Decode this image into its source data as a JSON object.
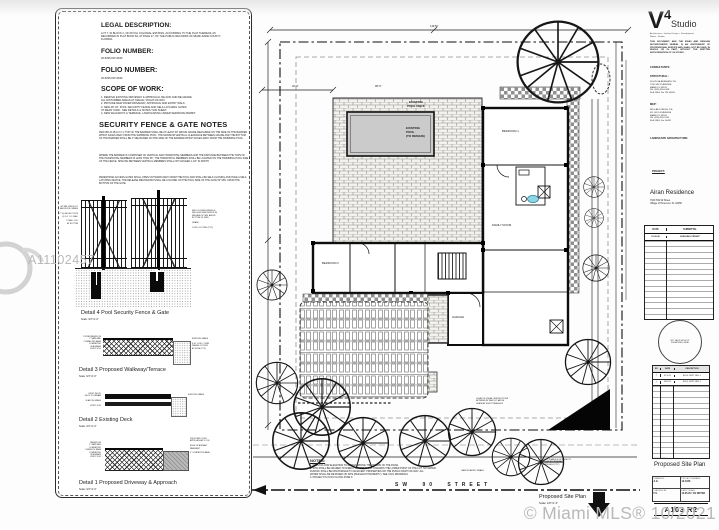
{
  "watermarks": {
    "listing_number": "A11102457",
    "mls_credit": "© Miami MLS® 10/2021"
  },
  "panel": {
    "legal_title": "LEGAL DESCRIPTION:",
    "legal_body": "LOT 7, IN BLOCK 2, OF ROYAL COLONIAL ESTATES, ACCORDING TO THE PLAT THEREOF, AS RECORDED IN PLAT BOOK 84, AT PAGE 27, OF THE PUBLIC RECORDS OF MIAMI-DADE COUNTY, FLORIDA.",
    "folio1_title": "FOLIO NUMBER:",
    "folio1_value": "20-5035-007-0630",
    "folio2_title": "FOLIO NUMBER:",
    "folio2_value": "20-5035-007-0630",
    "scope_title": "SCOPE OF WORK:",
    "scope_items": "1.  REMOVE EXISTING DRIVEWAY & APPROACH. RE-SOD AND RE-GRADE\n     ALL DISTURBED AREAS AT SWALE / RIGHT-OF-WAY.\n2.  PROVIDE NEW PAVER DRIVEWAY, APPROACH AND ENTRY WALK.\n3.  NEW 48\" HT. POOL SECURITY FENCE AND SELF-LATCHING GATES\n     AT REAR YARD - SEE DETAILS & NOTES THIS SHEET.\n4.  NEW WALKWAYS & TERRACE. LANDSCAPING UNDER SEPARATE PERMIT.",
    "security_title": "SECURITY FENCE & GATE NOTES",
    "security_p1": "PER FBC-R 454.2.17.1: TOP OF THE BARRIER SHALL BE AT LEAST 48\" ABOVE GRADE MEASURED ON THE SIDE OF THE BARRIER WHICH FACES AWAY FROM THE SWIMMING POOL. THE MAXIMUM VERTICAL CLEARANCE BETWEEN GRADE AND THE BOTTOM OF THE BARRIER SHALL BE 2\" MEASURED ON THE SIDE OF THE BARRIER WHICH FACES AWAY FROM THE SWIMMING POOL.",
    "security_p2": "WHERE THE BARRIER IS COMPOSED OF VERTICAL AND HORIZONTAL MEMBERS AND THE DISTANCE BETWEEN THE TOPS OF THE HORIZONTAL MEMBERS IS LESS THAN 45\", THE HORIZONTAL MEMBERS SHALL BE LOCATED ON THE SWIMMING POOL SIDE OF THE FENCE. SPACING BETWEEN VERTICAL MEMBERS SHALL NOT EXCEED 1-3/4\" IN WIDTH.",
    "security_p3": "PEDESTRIAN ACCESS GATES SHALL OPEN OUTWARD AWAY FROM THE POOL AND SHALL BE SELF-CLOSING AND HAVE A SELF-LATCHING DEVICE. THE RELEASE MECHANISM SHALL BE LOCATED ON THE POOL SIDE OF THE GATE 54\" MIN. FROM THE BOTTOM OF THE GATE.",
    "d4_label": "Detail 4 Pool Security Fence & Gate",
    "d4_scale": "Scale: 3/4\"=1'-0\"",
    "d4_ann_left": "48\" MIN. FENCE HT.\nABOVE FIN. GRADE\n\n2\" SQ. ALUM. POSTS\n@ 6'-0\" O.C. MAX.\n\n2\" MAX. CLR.\nAT BOTTOM",
    "d4_ann_right": "SELF-CLOSING HINGES &\nSELF-LATCHING DEVICE W/\nRELEASE 54\" MIN. ABOVE\nBOTTOM OF GATE\n\nGRADE\n\nCONC. FOOTING (TYP.)",
    "d3_label": "Detail 3 Proposed Walkway/Terrace",
    "d3_scale": "Scale: 3/4\"=1'-0\"",
    "d3_ann_left": "STONE PAVERS ON\n1\" SAND BED\nCOMPACTED BASE\nCOMPACTED\nSUBGRADE\nEXIST. SOIL",
    "d3_ann_right": "EXISTING GRADE\n\n6\"x6\" CONC. CURB\nWHERE OCCURS\nAT EDGE (TYP.)",
    "d2_label": "Detail 2 Existing Deck",
    "d2_scale": "Scale: 3/4\"=1'-0\"",
    "d2_ann_left": "EXIST. WOOD\nDECK TO REMAIN\n\nSLAB ON GRADE\n\nEXIST. SOIL",
    "d2_ann_right": "EXISTING GRADE",
    "d1_label": "Detail 1 Proposed Driveway & Approach",
    "d1_scale": "Scale: 3/4\"=1'-0\"",
    "d1_ann_left": "PAVERS ON\n1\" SAND BED\nCOMPACTED\nLIMEROCK BASE\nCOMPACTED\nSUBGRADE\nEXIST. SOIL",
    "d1_ann_right": "PROPOSED CONC.\nAPPROACH AT R.O.W.\n\nEDGE OF ASPHALT\nPAVEMENT\n\n6\" COMPACTED BASE"
  },
  "plan": {
    "dim_top": "149.50'",
    "dim_a": "40'-0\"",
    "dim_b": "98'-0\"",
    "pool_deck_label": "EXISTING\nPOOL DECK",
    "pool_label": "EXISTING\nPOOL\n(TO REMAIN)",
    "room1": "BEDROOM 1",
    "room2": "BEDROOM 2",
    "room3": "FAMILY ROOM",
    "room4": "GARAGE",
    "street": "SW 90 STREET",
    "notes_title": "NOTES:",
    "notes_body": "1.  FINISH FLOOR ELEVATION TO REMAIN ABOVE THE CROWN OF THE ROAD.\n2.  SITE SHALL BE GRADED TO DIRECT STREET FLOW TOWARDS THE LOWER POINT OF THE LOT. NO WATER\n     RUNOFF SHALL BE DISCHARGED TO ADJACENT PROPERTIES OR THE PUBLIC RIGHT-OF-WAY. ALL\n     WATER SHALL BE RETAINED ON SITE (PER EACH PROPERTY). SEE CIVIL DRAWINGS.\n3.  PROJECT IS IN NO FLOOD ZONE X.",
    "sight_note": "CLEAR OF VISUAL OBSTRUCTIONS\nBETWEEN 30\" AND 8'-0\" ABOVE\nGRADE AT SIGHT TRIANGLES",
    "sight_note2": "KEEP TRIANGLE OF VISIBILITY\nCLEAR AT DRIVEWAY\nAPPROACH (TYP.)",
    "swale": "LANDSCAPED SWALE",
    "title": "Proposed Site Plan",
    "scale": "Scale: 1/8\"=1'-0\""
  },
  "titleblock": {
    "logo_v": "V",
    "logo_4": "4",
    "logo_studio": "Studio",
    "tagline": "Architecture + Interior Design + Development\nMiami  ·  Florida",
    "copyright": "THIS DOCUMENT, AND THE IDEAS AND DESIGNS INCORPORATED HEREIN, IS AN INSTRUMENT OF PROFESSIONAL SERVICE AND SHALL NOT BE USED, IN WHOLE OR IN PART, WITHOUT THE WRITTEN AUTHORIZATION OF V4 STUDIO.",
    "consultants_label": "CONSULTANTS:",
    "structural_label": "STRUCTURAL:",
    "structural": "FULVIO ALBERGHINI, P.E.\n7700 SW 57 AVENUE\nMIAMI, FL 33143\nPH. (305) 555-0148\nFLA. REG. No. PE 55456",
    "mep_label": "MEP:",
    "mep": "BID-LAB STRUSS, P.E.\n411 SW 142 AVENUE\nMIAMI, FL 33184\nPH. (305) 555-2145\nFLA. REG. No. 60421",
    "landscape_label": "LANDSCAPE ARCHITECTURE:",
    "project_label": "PROJECT:",
    "project_name": "Airan Residence",
    "project_address": "7020 SW 90 Street\nVillage of Pinecrest, FL 33156",
    "sub_h1": "DATE",
    "sub_h2": "SUBMITTAL",
    "sub_r1_date": "10.05.20",
    "sub_r1_desc": "BUILDING PERMIT",
    "seal_text": "NOT VALID WITHOUT\nSIGNATURE & SEAL",
    "rev_h0": "NO.",
    "rev_h1": "DATE",
    "rev_h2": "DESCRIPTION",
    "rev_r1_no": "△",
    "rev_r1_date": "01.15.21",
    "rev_r1_desc": "BLDG. DEPT. REV. 1",
    "rev_r2_no": "△",
    "rev_r2_date": "03.02.21",
    "rev_r2_desc": "BLDG. DEPT. REV. 2",
    "sheet_title_label": "SHEET TITLE:",
    "sheet_title": "Proposed Site Plan",
    "info_l1": "DRAWN BY:",
    "info_v1": "A.G.",
    "info_l2": "PROJECT NUMBER:",
    "info_v2": "19-1026",
    "info_l3": "CHECKED BY:",
    "info_v3": "F.V.",
    "info_l4": "DATE / SCALE:",
    "info_v4": "10.05.20 / AS NOTED",
    "sheet_number": "A103 R2"
  }
}
